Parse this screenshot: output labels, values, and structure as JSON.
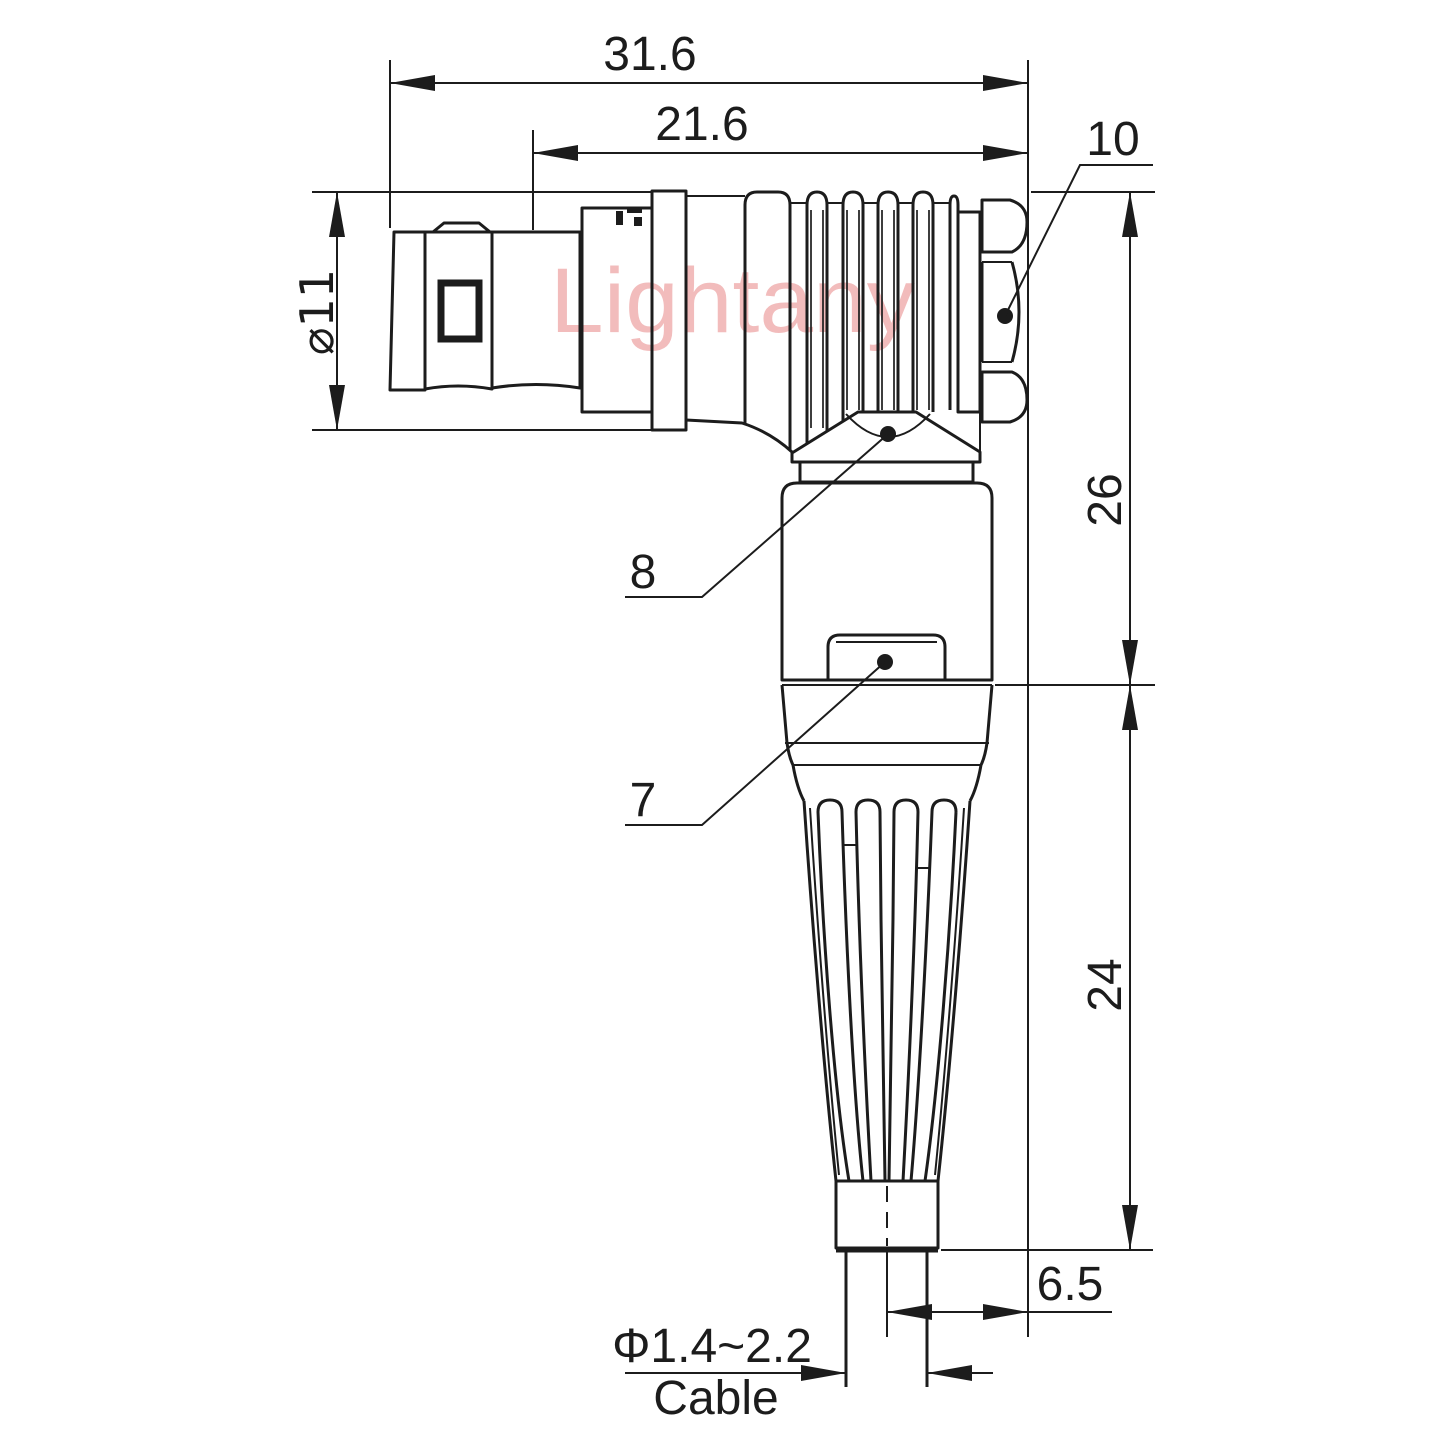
{
  "title": "Right-angle push-pull connector - dimensioned engineering drawing",
  "watermark": "Lightany",
  "colors": {
    "line": "#1c1c1c",
    "watermark": "#f2bcbc",
    "background": "#ffffff"
  },
  "dimensions": {
    "overall_length": "31.6",
    "rear_length": "21.6",
    "shell_diameter": "⌀11",
    "elbow_upper_height": "26",
    "strain_relief_height": "24",
    "cable_exit_offset": "6.5",
    "cable_diameter_range": "Φ1.4~2.2",
    "cable_word": "Cable"
  },
  "callouts": {
    "coupling_nut": "10",
    "elbow_backnut": "8",
    "latch_sleeve": "7"
  }
}
